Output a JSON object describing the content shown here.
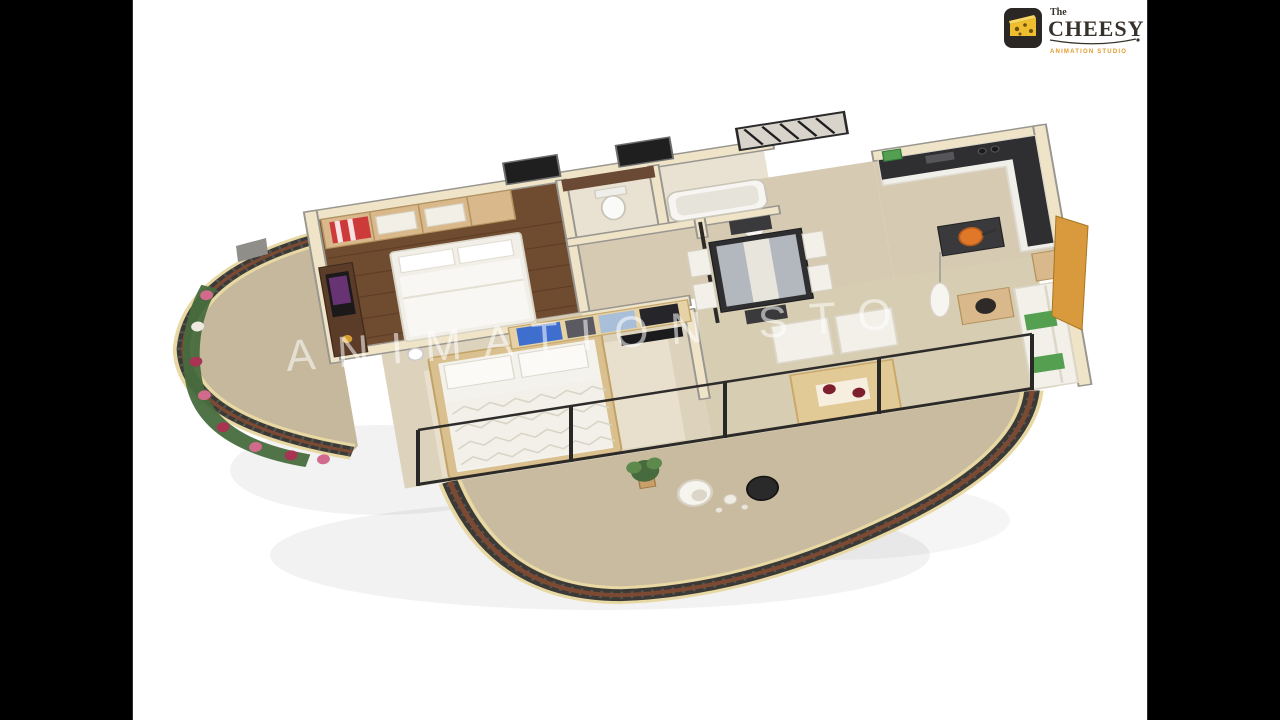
{
  "logo": {
    "the": "The",
    "name": "CHEESY",
    "tagline": "ANIMATION STUDIO"
  },
  "watermark": {
    "text": "ANIMATION STO"
  },
  "colors": {
    "background": "#ffffff",
    "letterbox": "#000000",
    "logo_bg": "#2b2724",
    "cheese": "#efbe2e",
    "cheese_hole": "#6b4e10",
    "logo_text": "#37322b",
    "logo_accent": "#e09a2c",
    "watermark": "rgba(255,255,255,0.55)",
    "wall": "#efe4c8",
    "wall_top": "#999690",
    "wood_floor": "#6f4b30",
    "wardrobe_wood": "#d9b98c",
    "tile": "#e9e1d2",
    "tile_warm": "#d6cbb2",
    "floor_beige": "#ddd3bc",
    "counter": "#2f2f31",
    "white_furn": "#f2f0e9",
    "red_accent": "#cc3a3a",
    "blue_accent": "#3f6fce",
    "blue_light": "#a9bfd9",
    "green_accent": "#55a050",
    "orange_accent": "#e0782a",
    "amber_panel": "#d89a3c",
    "railing": "#3b3a37",
    "rail_top": "#7c4a33",
    "base_trim": "#e7d8a4",
    "flower_pink": "#d26a8c",
    "flower_deep": "#a83352",
    "foliage": "#476b3e",
    "purple_accent": "#7a3a8a",
    "glass": "#c6ccd3"
  },
  "scene": {
    "type": "isometric-3d-floorplan-render",
    "rooms": [
      "master-bedroom",
      "ensuite-bathroom",
      "bathroom",
      "hallway",
      "dining-area",
      "kitchen",
      "second-bedroom",
      "living-room",
      "flower-balcony",
      "curved-terrace"
    ],
    "furniture": [
      "master-bed",
      "wardrobe",
      "tv-unit",
      "toilet",
      "bathtub",
      "washbasin",
      "dining-table",
      "dining-chairs",
      "kitchen-counter",
      "kitchen-island",
      "cooking-pan",
      "pendant-lamp",
      "second-bed",
      "storage-divider",
      "sofa",
      "lounge-chairs",
      "coffee-table",
      "side-table",
      "egg-chair",
      "pod-chair",
      "potted-palm",
      "flower-planter",
      "glass-doors",
      "balcony-railing"
    ]
  }
}
